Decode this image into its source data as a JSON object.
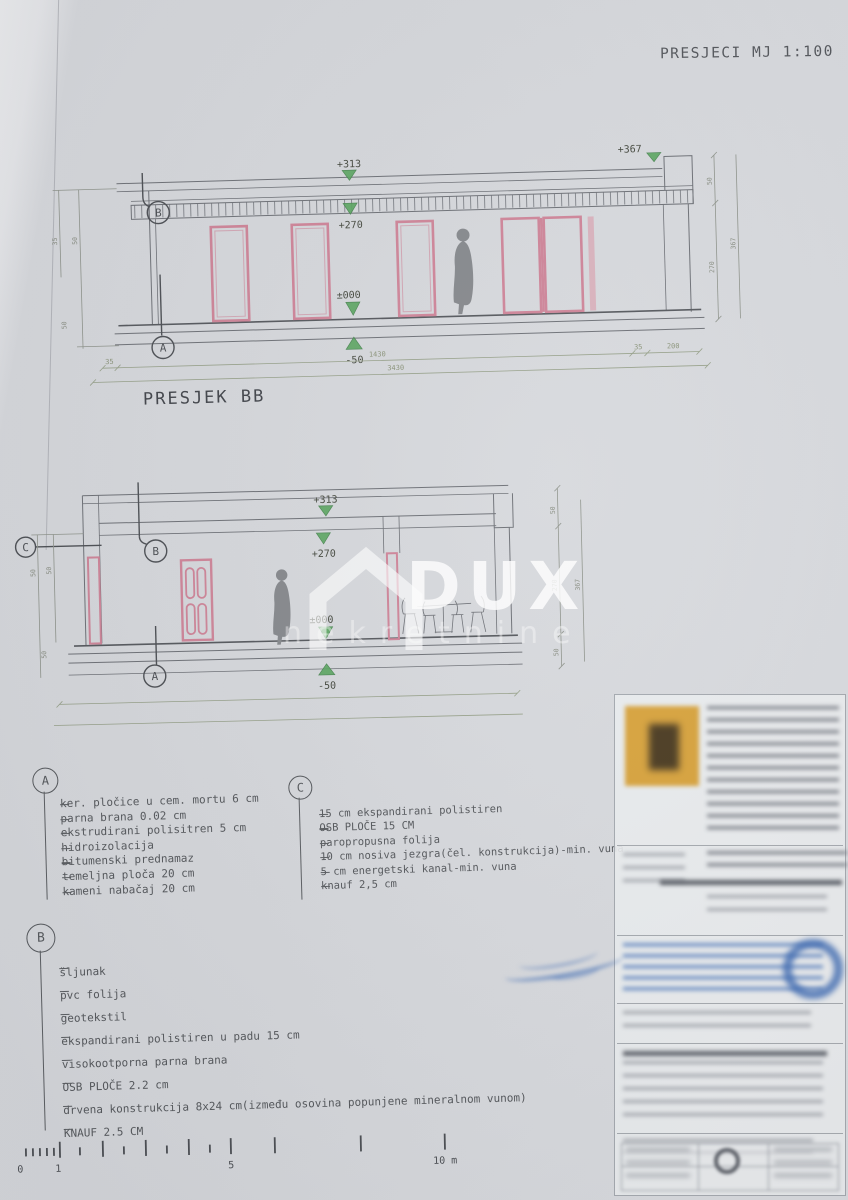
{
  "page": {
    "title": "PRESJECI MJ 1:100"
  },
  "colors": {
    "paper": "#d6d8dc",
    "line_gray": "#6d7076",
    "accent_pink": "#ce8498",
    "accent_green": "#58a55e",
    "logo_orange": "#d8a33c",
    "stamp_blue": "#3f6cb5",
    "watermark_white": "#ffffff"
  },
  "section1": {
    "label": "PRESJEK BB",
    "marker_top": "B",
    "marker_bottom": "A",
    "elev": {
      "roof": "+313",
      "ceiling": "+270",
      "floor": "±000",
      "below": "-50",
      "parapet": "+367"
    },
    "dims_bottom": [
      "35",
      "1430",
      "35",
      "200"
    ],
    "dim_total": "3430",
    "dims_left": [
      "35",
      "50",
      "50"
    ],
    "dims_right": [
      "50",
      "270",
      "367"
    ]
  },
  "section2": {
    "marker_left": "C",
    "marker_top": "B",
    "marker_bottom": "A",
    "elev": {
      "roof": "+313",
      "ceiling": "+270",
      "floor": "±000",
      "below": "-50"
    },
    "dims_left": [
      "50",
      "50",
      "50"
    ],
    "dims_right": [
      "50",
      "270",
      "50"
    ],
    "dim_total": "367"
  },
  "watermark": {
    "brand": "DUX",
    "sub": "nekretnine"
  },
  "legend_a": {
    "marker": "A",
    "items": [
      "ker. pločice u cem. mortu 6 cm",
      "parna brana 0.02 cm",
      "ekstrudirani polisitren 5 cm",
      "hidroizolacija",
      "bitumenski prednamaz",
      "temeljna ploča 20 cm",
      "kameni nabačaj 20 cm"
    ]
  },
  "legend_c": {
    "marker": "C",
    "items": [
      "15 cm ekspandirani polistiren",
      "OSB PLOČE 15 CM",
      "paropropusna folija",
      "10 cm nosiva jezgra(čel. konstrukcija)-min. vuna",
      "5 cm energetski kanal-min. vuna",
      "knauf 2,5 cm"
    ]
  },
  "legend_b": {
    "marker": "B",
    "items": [
      "šljunak",
      "pvc folija",
      "geotekstil",
      "ekspandirani polistiren u padu 15 cm",
      "visokootporna parna brana",
      "OSB PLOČE 2.2 cm",
      "drvena konstrukcija 8x24 cm(između osovina popunjene mineralnom vunom)",
      "KNAUF 2.5 CM"
    ]
  },
  "scalebar": {
    "labels": [
      "0",
      "1",
      "5",
      "10 m"
    ]
  }
}
